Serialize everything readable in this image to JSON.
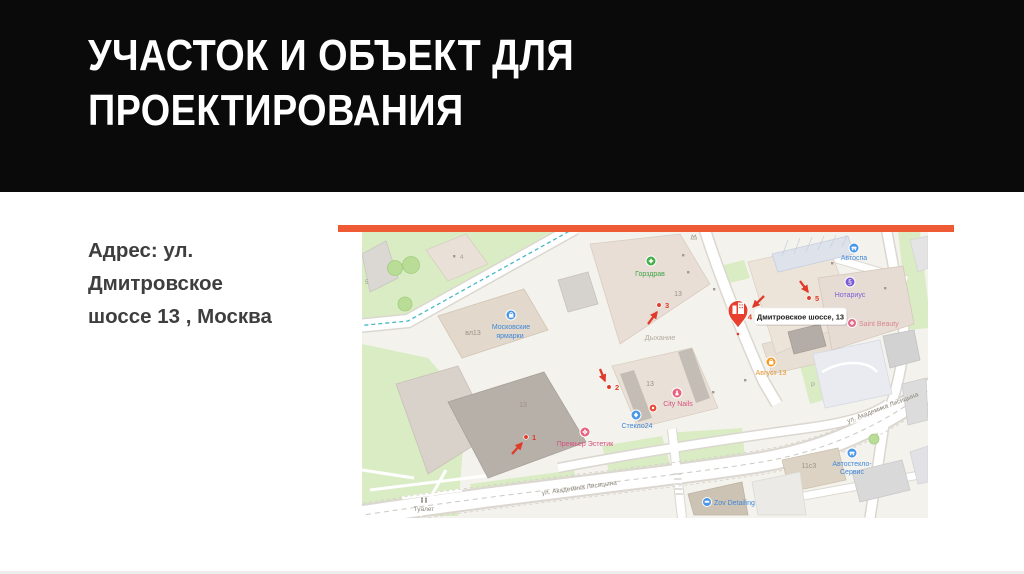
{
  "slide": {
    "title": "УЧАСТОК И ОБЪЕКТ ДЛЯ\nПРОЕКТИРОВАНИЯ",
    "address": "Адрес: ул.\nДмитровское\nшоссе 13 , Москва",
    "accent_color": "#ee5a33",
    "header_bg": "#0a0a0a"
  },
  "map": {
    "pin_label": "Дмитровское шоссе, 13",
    "markers": {
      "m1": "1",
      "m2": "2",
      "m3": "3",
      "m4": "4",
      "m5": "5"
    },
    "streets": {
      "lisitsyna": "ул. Академика Лисицына"
    },
    "buildings": {
      "b13": "13",
      "vl13": "вл13",
      "b11s3": "11с3",
      "b4": "4",
      "b5": "5",
      "parking": "Р"
    },
    "poi": {
      "gorzdrav": "Горздрав",
      "dyhanie": "Дыхание",
      "mosk1": "Московские",
      "mosk2": "ярмарки",
      "steklo": "Стекло24",
      "citynails": "City Nails",
      "premier": "Премьер Эстетик",
      "avgust": "Август 13",
      "avtospa": "Автоспа",
      "notarius": "Нотариус",
      "saint": "Saint Beauty",
      "avtosteklo1": "Автостекло-",
      "avtosteklo2": "Сервис",
      "zov": "Zov Detailing",
      "tualet": "Туалет",
      "notary_glyph": "§"
    },
    "icons": {
      "gorzdrav": "medical-plus",
      "mosk": "shopping-bag",
      "steklo": "glass-diamond",
      "citynails": "nail-polish",
      "premier": "flower",
      "avgust": "shopping-bag",
      "avtospa": "car",
      "notarius": "section-sign",
      "saint": "flower",
      "avtosteklo": "car",
      "zov": "car",
      "pin": "building",
      "tualet": "wc-figures"
    },
    "colors": {
      "marker_red": "#e03a2a",
      "pin_red": "#e8402f",
      "poi_blue": "#3f87d9",
      "poi_green": "#3fa344",
      "poi_pink": "#d6517e",
      "poi_orange": "#e8952f",
      "poi_violet": "#7a5cd6",
      "green_area": "#d9ecc3",
      "building_beige": "#e9e1d7",
      "road_white": "#ffffff"
    }
  }
}
